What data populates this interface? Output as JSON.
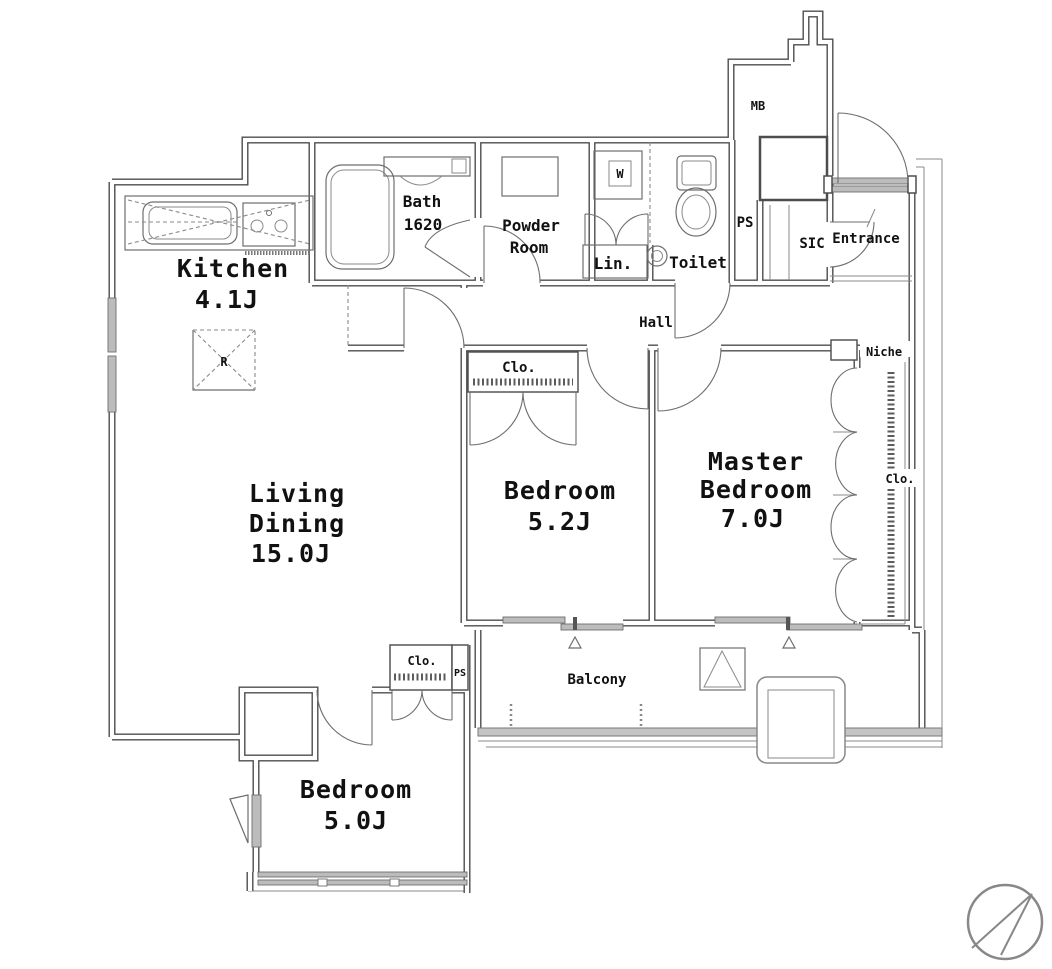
{
  "plan": {
    "title": "apartment-floor-plan",
    "rooms": {
      "living_dining": {
        "line1": "Living",
        "line2": "Dining",
        "size": "15.0J"
      },
      "kitchen": {
        "line1": "Kitchen",
        "size": "4.1J"
      },
      "bedroom_5_2": {
        "line1": "Bedroom",
        "size": "5.2J"
      },
      "master_bedroom": {
        "line1": "Master",
        "line2": "Bedroom",
        "size": "7.0J"
      },
      "bedroom_5_0": {
        "line1": "Bedroom",
        "size": "5.0J"
      },
      "bath": {
        "line1": "Bath",
        "size": "1620"
      },
      "powder_room": {
        "line1": "Powder",
        "line2": "Room"
      },
      "linen": {
        "label": "Lin."
      },
      "toilet": {
        "label": "Toilet"
      },
      "hall": {
        "label": "Hall"
      },
      "entrance": {
        "label": "Entrance"
      },
      "shoes_closet": {
        "label": "SIC"
      },
      "balcony": {
        "label": "Balcony"
      }
    },
    "annotations": {
      "meter_box": "MB",
      "pipe_shaft_top": "PS",
      "pipe_shaft_living": "PS",
      "niche": "Niche",
      "closet_bedroom_5_2": "Clo.",
      "closet_master": "Clo.",
      "closet_bedroom_5_0": "Clo.",
      "refrigerator_mark": "R",
      "washer_mark": "W"
    },
    "colors": {
      "wall": "#4d4d4d",
      "fixture": "#777777",
      "glass": "#bcbcbc",
      "text": "#111111",
      "bg": "#ffffff"
    }
  }
}
